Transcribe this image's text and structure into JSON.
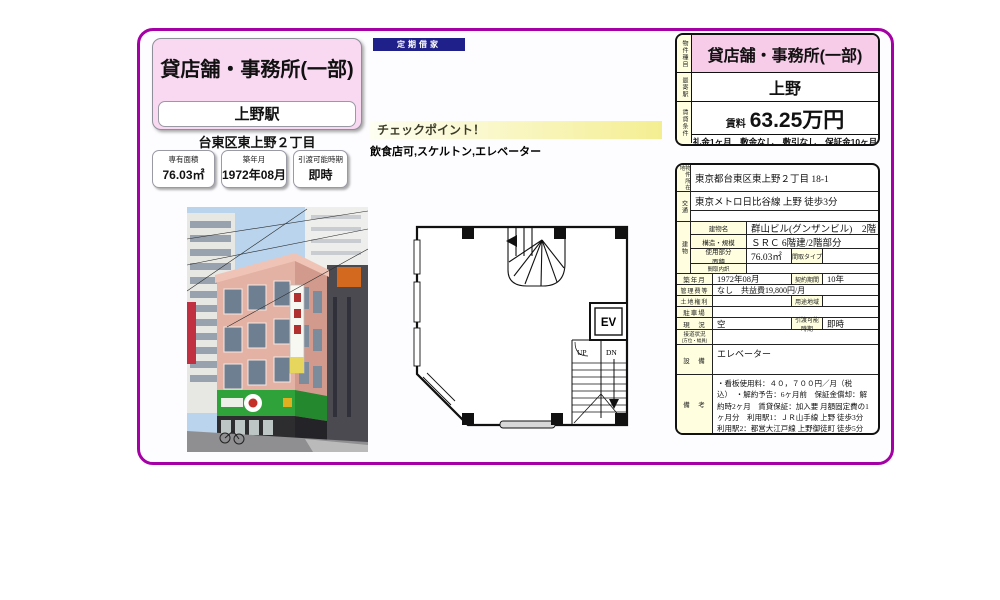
{
  "colors": {
    "frame": "#A500A5",
    "pink": "#F9D8F2",
    "pink_cell": "#F7CCE9",
    "navy": "#20208A",
    "cream": "#FFFFE0"
  },
  "header_card": {
    "title": "貸店舗・事務所(一部)",
    "station": "上野駅",
    "address_short": "台東区東上野２丁目"
  },
  "tenancy_badge": "定期借家",
  "quick_facts": [
    {
      "label": "専有面積",
      "value": "76.03㎡"
    },
    {
      "label": "築年月",
      "value": "1972年08月"
    },
    {
      "label": "引渡可能時期",
      "value": "即時"
    }
  ],
  "checkpoint": {
    "title": "チェックポイント！",
    "features": "飲食店可,スケルトン,エレベーター"
  },
  "summary": {
    "type_label": "物件種目",
    "type_value": "貸店舗・事務所(一部)",
    "station_label": "最寄駅",
    "station_value": "上野",
    "terms_label": "賃貸条件",
    "rent_label": "賃料",
    "rent_value": "63.25万円",
    "terms_detail": "礼金1ヶ月　敷金なし　敷引なし　保証金10ヶ月"
  },
  "details": {
    "address": {
      "label": "物件所在地",
      "value": "東京都台東区東上野２丁目 18-1"
    },
    "access": {
      "label": "交通",
      "value": "東京メトロ日比谷線 上野 徒歩3分"
    },
    "building": {
      "label": "建物",
      "name": {
        "label": "建物名",
        "value": "群山ビル(グンザンビル)　2階"
      },
      "structure": {
        "label": "構造・規模",
        "value": "ＳＲＣ 6階建/2階部分"
      },
      "area": {
        "label1": "使用部分",
        "label2": "面積",
        "value": "76.03㎡"
      },
      "layout_type": {
        "label": "間取タイプ",
        "value": ""
      },
      "layout_detail": {
        "label": "間取内訳",
        "value": ""
      }
    },
    "built": {
      "label": "築年月",
      "value": "1972年08月"
    },
    "contract": {
      "label": "契約期間",
      "value": "10年"
    },
    "fees": {
      "label": "管理費等",
      "value": "なし　共益費19,800円/月"
    },
    "land_rights": {
      "label": "土地権利",
      "value": ""
    },
    "zoning": {
      "label": "用途地域",
      "value": ""
    },
    "parking": {
      "label": "駐車場",
      "value": ""
    },
    "status": {
      "label": "現　況",
      "value": "空"
    },
    "handover": {
      "label1": "引渡可能",
      "label2": "時期",
      "value": "即時"
    },
    "road": {
      "label1": "接道状況",
      "label2": "(方位・幅員)",
      "value": ""
    },
    "equipment": {
      "label": "設　備",
      "value": "エレベーター"
    },
    "notes": {
      "label": "備　考",
      "value": "・看板使用料：４０，７００円／月（税込）　・解約予告：6ヶ月前　保証金償却：解約時2ヶ月　賃貸保証：加入要 月額固定費の1ヶ月分　利用駅1：ＪＲ山手線 上野 徒歩3分　利用駅2：都営大江戸線 上野御徒町 徒歩5分"
    }
  },
  "floor_plan": {
    "ev": "EV",
    "up": "UP",
    "dn": "DN"
  }
}
